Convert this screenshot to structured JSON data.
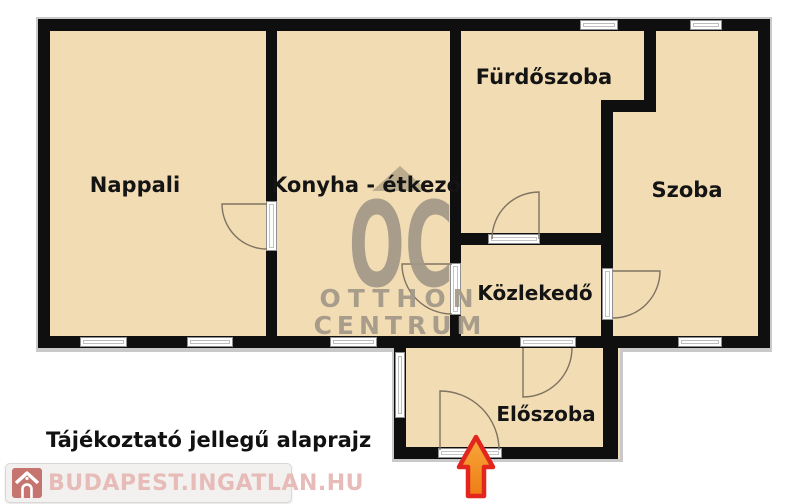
{
  "rooms": {
    "nappali": {
      "label": "Nappali"
    },
    "konyha": {
      "label": "Konyha - étkező"
    },
    "furdoszoba": {
      "label": "Fürdőszoba"
    },
    "szoba": {
      "label": "Szoba"
    },
    "kozlekedo": {
      "label": "Közlekedő"
    },
    "eloszoba": {
      "label": "Előszoba"
    }
  },
  "caption": "Tájékoztató jellegű alaprajz",
  "watermark": {
    "oc": "OC",
    "line1": "OTTHON",
    "line2": "CENTRUM"
  },
  "logo": {
    "text": "BUDAPEST.INGATLAN.HU"
  },
  "colors": {
    "wall": "#0f0f0f",
    "room_fill": "#f2dcb4",
    "watermark": "#a29887",
    "arrow_fill_top": "#f8a83d",
    "arrow_fill_bottom": "#ee7d15",
    "arrow_stroke": "#e3261d",
    "logo_text": "#e7bcb8",
    "logo_icon_bg": "#c57470"
  }
}
